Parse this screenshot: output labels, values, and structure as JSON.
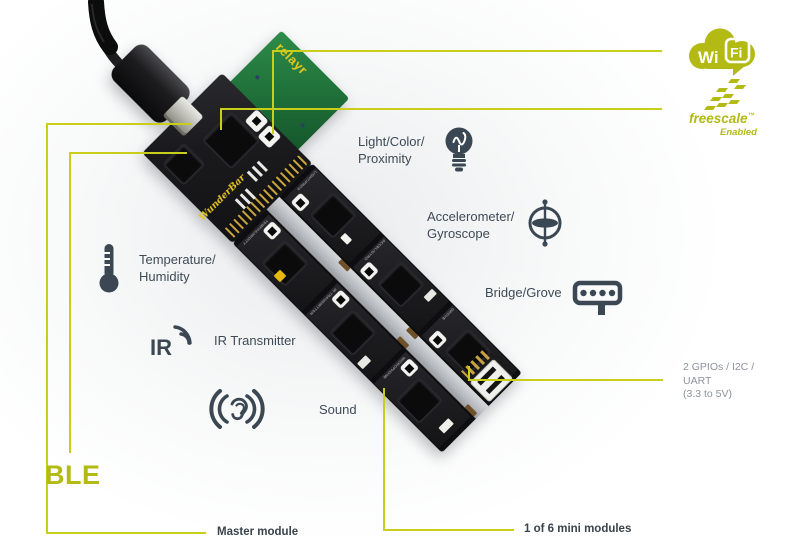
{
  "colors": {
    "accent_line": "#c9ce1a",
    "accent_logo": "#b3ba14",
    "text_dark": "#3e4b57",
    "text_gray": "#8b939c",
    "board_yellow": "#e8c61e",
    "icon_slate": "#3b4854"
  },
  "board": {
    "brand": "WunderBar",
    "wifi_module_label": "relayr",
    "modules": [
      {
        "silk": "LIGHT/PROX"
      },
      {
        "silk": "ACCEL/GYRO"
      },
      {
        "silk": "GROVE"
      },
      {
        "silk": "TEMP/HUMIDITY"
      },
      {
        "silk": "IR TRANSMITTER"
      },
      {
        "silk": "MICROPHONE"
      }
    ]
  },
  "callouts": {
    "wifi": {
      "wi": "Wi",
      "fi": "Fi"
    },
    "freescale": {
      "name": "freescale",
      "tm": "™",
      "enabled": "Enabled"
    },
    "light": "Light/Color/\nProximity",
    "accelerometer": "Accelerometer/\nGyroscope",
    "bridge": "Bridge/Grove",
    "temperature": "Temperature/\nHumidity",
    "ir": "IR Transmitter",
    "ir_icon_text": "IR",
    "sound": "Sound",
    "gpio": "2 GPIOs / I2C /\nUART\n(3.3 to 5V)",
    "ble": "BLE",
    "master": "Master module",
    "mini": "1 of 6 mini modules"
  }
}
